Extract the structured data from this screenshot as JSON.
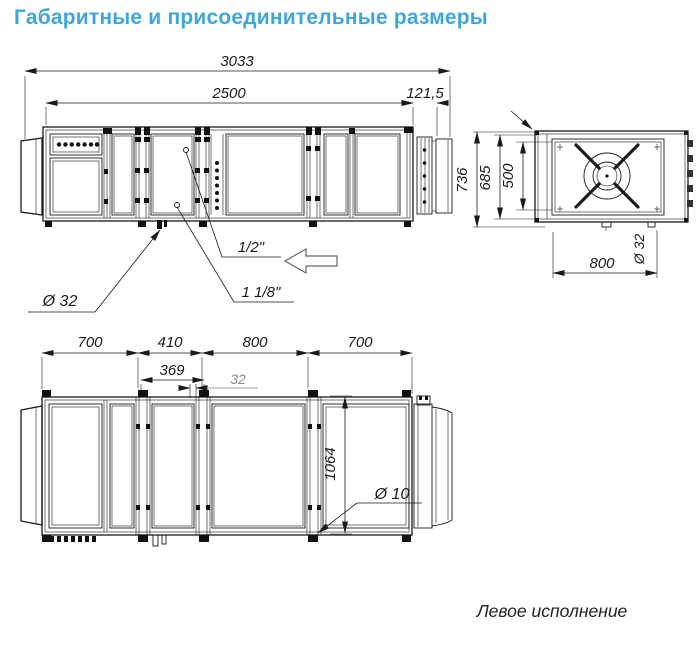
{
  "title": "Габаритные и присоединительные размеры",
  "caption": "Левое исполнение",
  "side_view": {
    "dim_overall_length": "3033",
    "dim_body_length": "2500",
    "dim_flange_length": "121,5",
    "label_pipe_small": "1/2\"",
    "label_pipe_large": "1 1/8\"",
    "label_drain_diameter": "Ø 32"
  },
  "end_view": {
    "dim_overall_height": "736",
    "dim_body_height": "685",
    "dim_opening_height": "500",
    "dim_fan_section_width": "800",
    "label_drain_diameter": "Ø 32"
  },
  "plan_view": {
    "dim_section_1": "700",
    "dim_section_2": "410",
    "dim_section_3": "800",
    "dim_section_4": "700",
    "dim_axis_offset": "369",
    "dim_small_offset": "32",
    "dim_mount_holes": "1064",
    "label_hole_diameter": "Ø 10"
  },
  "colors": {
    "accent": "#3fa6db",
    "line": "#1a1a1a",
    "dim_secondary": "#8a8a8a"
  }
}
